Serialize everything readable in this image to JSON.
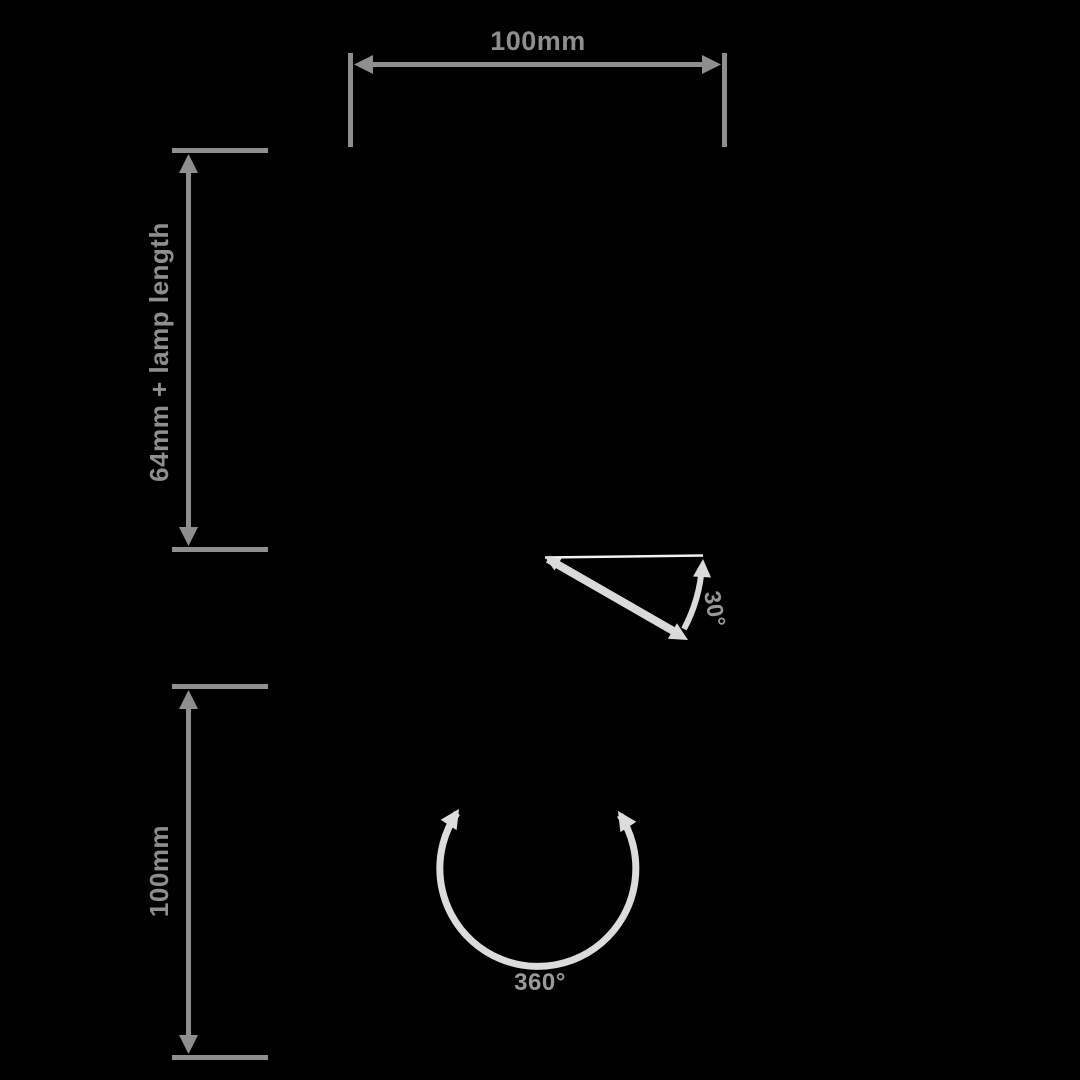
{
  "canvas": {
    "width": 1080,
    "height": 1080,
    "background": "#000000"
  },
  "colors": {
    "dimension_lines": "#8e8e8e",
    "tilt_arc": "#dadada",
    "reference_line": "#f2f2f2",
    "rotation_arc": "#dcdcdc",
    "angle_labels": "#999999"
  },
  "dimensions": {
    "width": {
      "label": "100mm"
    },
    "drop_height": {
      "label": "64mm + lamp length"
    },
    "lower_height": {
      "label": "100mm"
    }
  },
  "angles": {
    "tilt": {
      "label": "30°"
    },
    "rotation": {
      "label": "360°"
    }
  },
  "icons": {
    "dimension_arrow": "solid triangle",
    "arc_arrow": "solid triangle"
  }
}
